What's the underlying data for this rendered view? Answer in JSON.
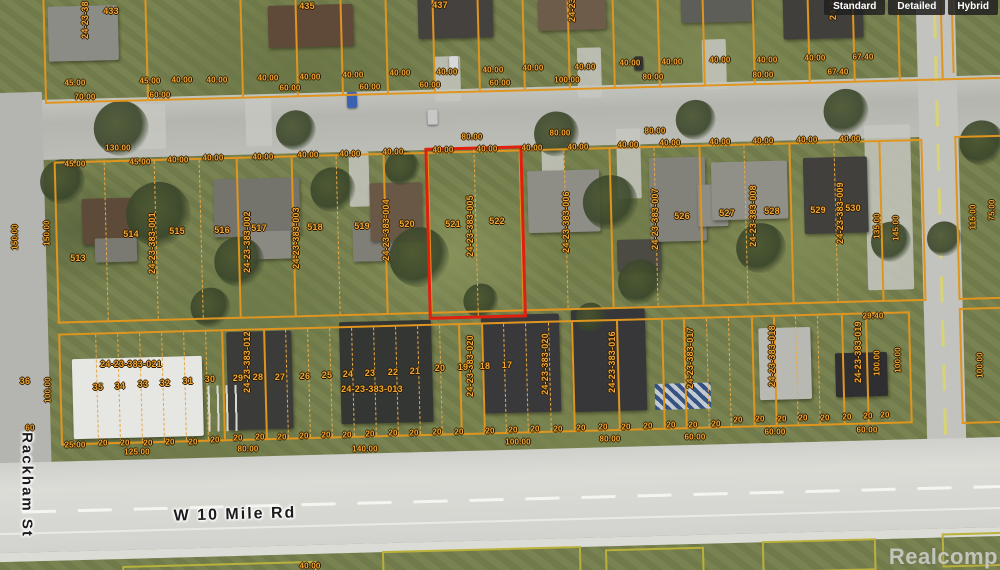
{
  "toolbar": {
    "buttons": [
      {
        "id": "standard",
        "label": "Standard"
      },
      {
        "id": "detailed",
        "label": "Detailed"
      },
      {
        "id": "hybrid",
        "label": "Hybrid"
      }
    ]
  },
  "watermark": "Realcomp",
  "streets": {
    "horizontal": "W 10 Mile Rd",
    "vertical": "Rackham St"
  },
  "highlight": {
    "parcel_id": "24-23-383-005",
    "lots": [
      "521",
      "522"
    ],
    "outline_color": "#e0200f"
  },
  "overlay_color": "#f5a733",
  "map_labels": {
    "parcel_ids": [
      {
        "t": "24-23-383-001",
        "x": 152,
        "y": 243,
        "o": "v"
      },
      {
        "t": "24-23-383-002",
        "x": 247,
        "y": 242,
        "o": "v"
      },
      {
        "t": "24-23-383-003",
        "x": 296,
        "y": 238,
        "o": "v"
      },
      {
        "t": "24-23-383-004",
        "x": 386,
        "y": 230,
        "o": "v"
      },
      {
        "t": "24-23-383-005",
        "x": 470,
        "y": 226,
        "o": "v"
      },
      {
        "t": "24-23-383-006",
        "x": 566,
        "y": 222,
        "o": "v"
      },
      {
        "t": "24-23-383-007",
        "x": 655,
        "y": 219,
        "o": "v"
      },
      {
        "t": "24-23-383-008",
        "x": 753,
        "y": 216,
        "o": "v"
      },
      {
        "t": "24-23-383-009",
        "x": 840,
        "y": 213,
        "o": "v"
      },
      {
        "t": "24-23-383-021",
        "x": 131,
        "y": 364,
        "o": "h"
      },
      {
        "t": "24-23-383-012",
        "x": 247,
        "y": 362,
        "o": "v"
      },
      {
        "t": "24-23-383-013",
        "x": 372,
        "y": 389,
        "o": "h"
      },
      {
        "t": "24-23-383-020",
        "x": 470,
        "y": 366,
        "o": "v"
      },
      {
        "t": "24-23-383-020",
        "x": 545,
        "y": 364,
        "o": "v"
      },
      {
        "t": "24-23-383-016",
        "x": 612,
        "y": 362,
        "o": "v"
      },
      {
        "t": "24-23-383-017",
        "x": 690,
        "y": 358,
        "o": "v"
      },
      {
        "t": "24-23-383-018",
        "x": 772,
        "y": 356,
        "o": "v"
      },
      {
        "t": "24-23-383-019",
        "x": 858,
        "y": 352,
        "o": "v"
      },
      {
        "t": "24-23-38",
        "x": 85,
        "y": 20,
        "o": "v"
      },
      {
        "t": "24-23",
        "x": 572,
        "y": 10,
        "o": "v"
      },
      {
        "t": "24-23",
        "x": 833,
        "y": 8,
        "o": "v"
      }
    ],
    "lot_numbers": [
      {
        "t": "513",
        "x": 78,
        "y": 258
      },
      {
        "t": "514",
        "x": 131,
        "y": 234
      },
      {
        "t": "515",
        "x": 177,
        "y": 231
      },
      {
        "t": "516",
        "x": 222,
        "y": 230
      },
      {
        "t": "517",
        "x": 259,
        "y": 228
      },
      {
        "t": "518",
        "x": 315,
        "y": 227
      },
      {
        "t": "519",
        "x": 362,
        "y": 226
      },
      {
        "t": "520",
        "x": 407,
        "y": 224
      },
      {
        "t": "521",
        "x": 453,
        "y": 224
      },
      {
        "t": "522",
        "x": 497,
        "y": 221
      },
      {
        "t": "526",
        "x": 682,
        "y": 216
      },
      {
        "t": "527",
        "x": 727,
        "y": 213
      },
      {
        "t": "528",
        "x": 772,
        "y": 211
      },
      {
        "t": "529",
        "x": 818,
        "y": 210
      },
      {
        "t": "530",
        "x": 853,
        "y": 208
      },
      {
        "t": "36",
        "x": 25,
        "y": 381
      },
      {
        "t": "35",
        "x": 98,
        "y": 387
      },
      {
        "t": "34",
        "x": 120,
        "y": 386
      },
      {
        "t": "33",
        "x": 143,
        "y": 384
      },
      {
        "t": "32",
        "x": 165,
        "y": 383
      },
      {
        "t": "31",
        "x": 188,
        "y": 381
      },
      {
        "t": "30",
        "x": 210,
        "y": 379
      },
      {
        "t": "29",
        "x": 238,
        "y": 378
      },
      {
        "t": "28",
        "x": 258,
        "y": 377
      },
      {
        "t": "27",
        "x": 280,
        "y": 377
      },
      {
        "t": "26",
        "x": 305,
        "y": 376
      },
      {
        "t": "25",
        "x": 327,
        "y": 375
      },
      {
        "t": "24",
        "x": 348,
        "y": 374
      },
      {
        "t": "23",
        "x": 370,
        "y": 373
      },
      {
        "t": "22",
        "x": 393,
        "y": 372
      },
      {
        "t": "21",
        "x": 415,
        "y": 371
      },
      {
        "t": "20",
        "x": 440,
        "y": 368
      },
      {
        "t": "19",
        "x": 463,
        "y": 367
      },
      {
        "t": "18",
        "x": 485,
        "y": 366
      },
      {
        "t": "17",
        "x": 507,
        "y": 365
      }
    ],
    "house_numbers": [
      {
        "t": "433",
        "x": 111,
        "y": 11
      },
      {
        "t": "435",
        "x": 307,
        "y": 6
      },
      {
        "t": "437",
        "x": 440,
        "y": 5
      }
    ],
    "dimensions": [
      {
        "t": "45.00",
        "x": 75,
        "y": 83
      },
      {
        "t": "45.00",
        "x": 150,
        "y": 81
      },
      {
        "t": "40.00",
        "x": 182,
        "y": 80
      },
      {
        "t": "40.00",
        "x": 217,
        "y": 80
      },
      {
        "t": "40.00",
        "x": 268,
        "y": 78
      },
      {
        "t": "40.00",
        "x": 310,
        "y": 77
      },
      {
        "t": "40.00",
        "x": 353,
        "y": 75
      },
      {
        "t": "40.00",
        "x": 400,
        "y": 73
      },
      {
        "t": "40.00",
        "x": 447,
        "y": 72
      },
      {
        "t": "40.00",
        "x": 493,
        "y": 70
      },
      {
        "t": "40.00",
        "x": 533,
        "y": 68
      },
      {
        "t": "40.00",
        "x": 585,
        "y": 67
      },
      {
        "t": "40.00",
        "x": 630,
        "y": 63
      },
      {
        "t": "40.00",
        "x": 672,
        "y": 62
      },
      {
        "t": "40.00",
        "x": 720,
        "y": 60
      },
      {
        "t": "40.00",
        "x": 767,
        "y": 60
      },
      {
        "t": "40.00",
        "x": 815,
        "y": 58
      },
      {
        "t": "67.40",
        "x": 863,
        "y": 57
      },
      {
        "t": "70.00",
        "x": 85,
        "y": 97
      },
      {
        "t": "60.00",
        "x": 160,
        "y": 95
      },
      {
        "t": "60.00",
        "x": 290,
        "y": 88
      },
      {
        "t": "60.00",
        "x": 370,
        "y": 87
      },
      {
        "t": "60.00",
        "x": 430,
        "y": 85
      },
      {
        "t": "60.00",
        "x": 500,
        "y": 83
      },
      {
        "t": "100.00",
        "x": 567,
        "y": 80
      },
      {
        "t": "80.00",
        "x": 653,
        "y": 77
      },
      {
        "t": "80.00",
        "x": 763,
        "y": 75
      },
      {
        "t": "67.40",
        "x": 838,
        "y": 72
      },
      {
        "t": "130.00",
        "x": 118,
        "y": 148
      },
      {
        "t": "80.00",
        "x": 472,
        "y": 137
      },
      {
        "t": "80.00",
        "x": 560,
        "y": 133
      },
      {
        "t": "80.00",
        "x": 655,
        "y": 131
      },
      {
        "t": "45.00",
        "x": 75,
        "y": 164
      },
      {
        "t": "45.00",
        "x": 140,
        "y": 162
      },
      {
        "t": "40.00",
        "x": 178,
        "y": 160
      },
      {
        "t": "40.00",
        "x": 213,
        "y": 158
      },
      {
        "t": "40.00",
        "x": 263,
        "y": 157
      },
      {
        "t": "40.00",
        "x": 308,
        "y": 155
      },
      {
        "t": "40.00",
        "x": 350,
        "y": 154
      },
      {
        "t": "40.00",
        "x": 393,
        "y": 152
      },
      {
        "t": "40.00",
        "x": 443,
        "y": 150
      },
      {
        "t": "40.00",
        "x": 487,
        "y": 149
      },
      {
        "t": "40.00",
        "x": 532,
        "y": 148
      },
      {
        "t": "40.00",
        "x": 578,
        "y": 147
      },
      {
        "t": "40.00",
        "x": 628,
        "y": 145
      },
      {
        "t": "40.00",
        "x": 670,
        "y": 143
      },
      {
        "t": "40.00",
        "x": 720,
        "y": 142
      },
      {
        "t": "40.00",
        "x": 763,
        "y": 141
      },
      {
        "t": "40.00",
        "x": 807,
        "y": 140
      },
      {
        "t": "40.00",
        "x": 850,
        "y": 139
      },
      {
        "t": "150.00",
        "x": 15,
        "y": 237,
        "o": "v"
      },
      {
        "t": "150.00",
        "x": 47,
        "y": 233,
        "o": "v"
      },
      {
        "t": "135.00",
        "x": 877,
        "y": 226,
        "o": "v"
      },
      {
        "t": "145.00",
        "x": 896,
        "y": 228,
        "o": "v"
      },
      {
        "t": "115.00",
        "x": 973,
        "y": 217,
        "o": "v"
      },
      {
        "t": "75.00",
        "x": 992,
        "y": 210,
        "o": "v"
      },
      {
        "t": "100.00",
        "x": 48,
        "y": 390,
        "o": "v"
      },
      {
        "t": "100.00",
        "x": 877,
        "y": 363,
        "o": "v"
      },
      {
        "t": "100.00",
        "x": 898,
        "y": 360,
        "o": "v"
      },
      {
        "t": "100.00",
        "x": 980,
        "y": 365,
        "o": "v"
      },
      {
        "t": "25.00",
        "x": 75,
        "y": 445
      },
      {
        "t": "125.00",
        "x": 137,
        "y": 452
      },
      {
        "t": "80.00",
        "x": 248,
        "y": 449
      },
      {
        "t": "140.00",
        "x": 365,
        "y": 449
      },
      {
        "t": "100.00",
        "x": 518,
        "y": 442
      },
      {
        "t": "80.00",
        "x": 610,
        "y": 439
      },
      {
        "t": "60.00",
        "x": 695,
        "y": 437
      },
      {
        "t": "60.00",
        "x": 775,
        "y": 432
      },
      {
        "t": "60.00",
        "x": 867,
        "y": 430
      },
      {
        "t": "29.40",
        "x": 873,
        "y": 316
      },
      {
        "t": "40.00",
        "x": 310,
        "y": 566
      },
      {
        "t": "60",
        "x": 30,
        "y": 428
      }
    ],
    "dims_20": {
      "text": "20",
      "points": [
        [
          103,
          443
        ],
        [
          125,
          443
        ],
        [
          148,
          443
        ],
        [
          170,
          442
        ],
        [
          193,
          442
        ],
        [
          215,
          440
        ],
        [
          238,
          438
        ],
        [
          260,
          437
        ],
        [
          282,
          437
        ],
        [
          304,
          436
        ],
        [
          326,
          435
        ],
        [
          347,
          435
        ],
        [
          370,
          434
        ],
        [
          393,
          433
        ],
        [
          414,
          433
        ],
        [
          437,
          432
        ],
        [
          459,
          432
        ],
        [
          490,
          431
        ],
        [
          513,
          430
        ],
        [
          535,
          429
        ],
        [
          558,
          429
        ],
        [
          581,
          428
        ],
        [
          603,
          427
        ],
        [
          626,
          427
        ],
        [
          648,
          426
        ],
        [
          671,
          425
        ],
        [
          693,
          425
        ],
        [
          716,
          424
        ],
        [
          738,
          420
        ],
        [
          760,
          419
        ],
        [
          782,
          419
        ],
        [
          803,
          418
        ],
        [
          825,
          418
        ],
        [
          847,
          417
        ],
        [
          868,
          416
        ],
        [
          885,
          415
        ]
      ]
    }
  }
}
